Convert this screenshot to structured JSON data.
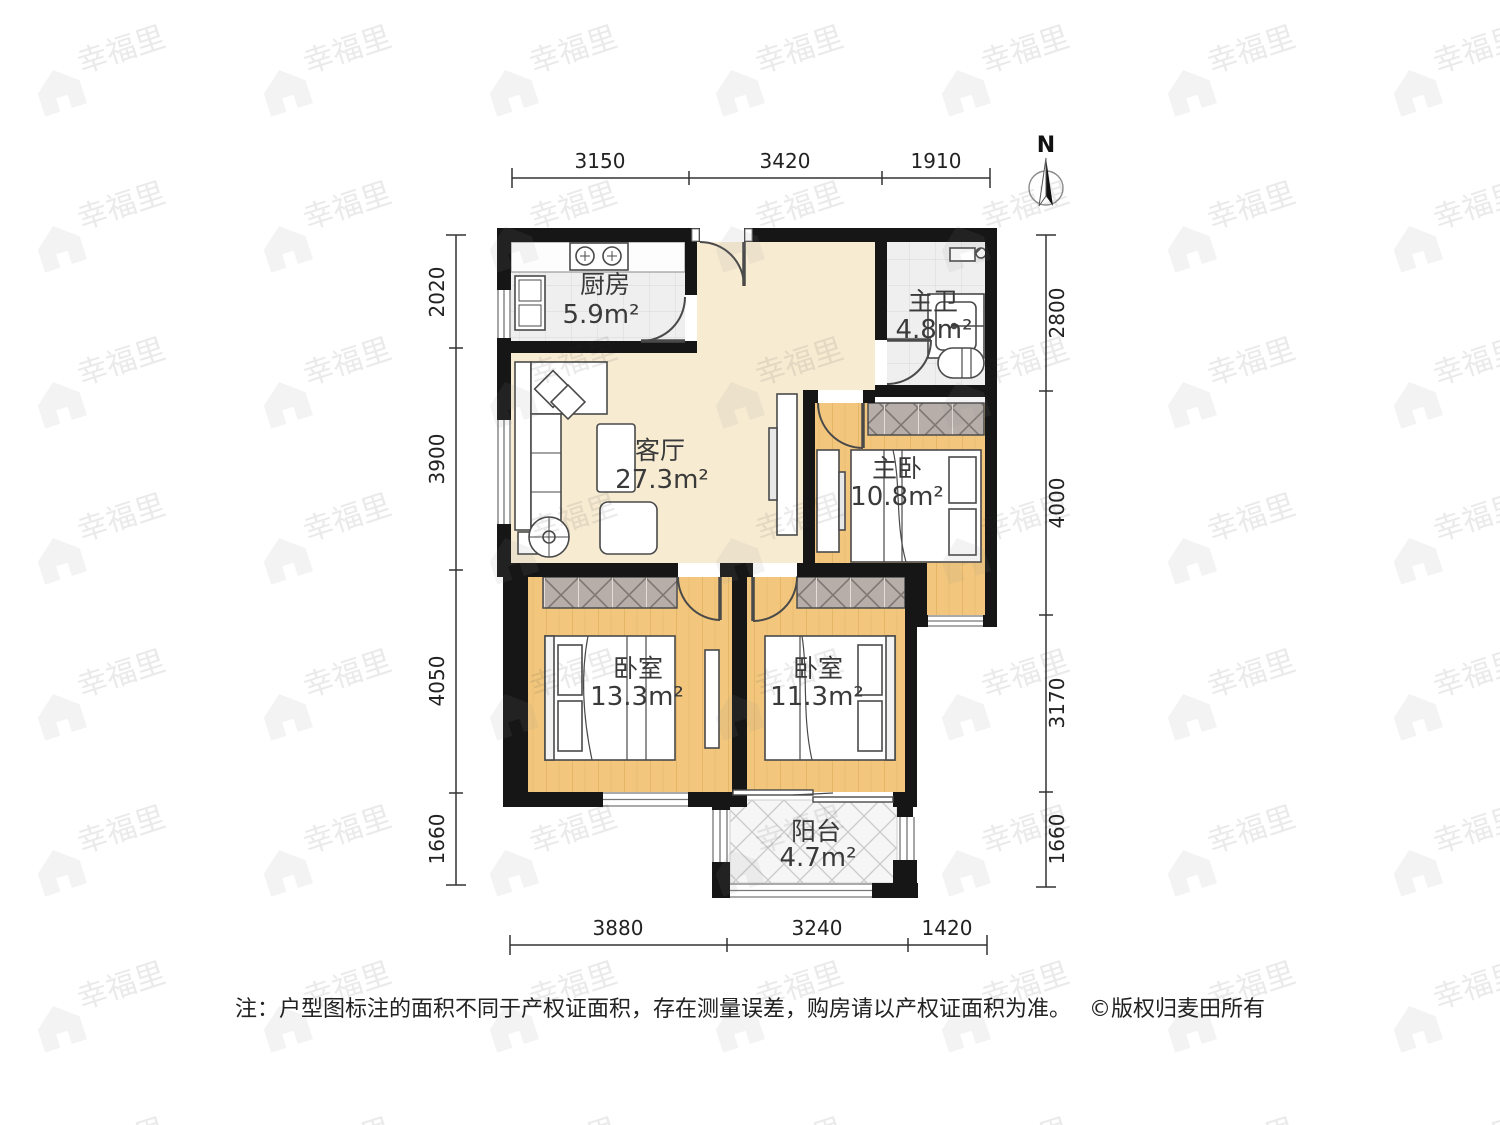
{
  "compass": {
    "label": "N"
  },
  "rooms": [
    {
      "id": "kitchen",
      "name": "厨房",
      "area": "5.9m²"
    },
    {
      "id": "master-bath",
      "name": "主卫",
      "area": "4.8m²"
    },
    {
      "id": "living-room",
      "name": "客厅",
      "area": "27.3m²"
    },
    {
      "id": "master-bedroom",
      "name": "主卧",
      "area": "10.8m²"
    },
    {
      "id": "bedroom-west",
      "name": "卧室",
      "area": "13.3m²"
    },
    {
      "id": "bedroom-east",
      "name": "卧室",
      "area": "11.3m²"
    },
    {
      "id": "balcony",
      "name": "阳台",
      "area": "4.7m²"
    }
  ],
  "dimensions": {
    "top": [
      "3150",
      "3420",
      "1910"
    ],
    "left": [
      "2020",
      "3900",
      "4050",
      "1660"
    ],
    "right": [
      "2800",
      "4000",
      "3170",
      "1660"
    ],
    "bottom": [
      "3880",
      "3240",
      "1420"
    ]
  },
  "footer": {
    "note": "注：户型图标注的面积不同于产权证面积，存在测量误差，购房请以产权证面积为准。",
    "copyright": "©版权归麦田所有"
  },
  "watermark": {
    "text": "幸福里"
  },
  "colors": {
    "wall": "#161616",
    "hall_floor": "#f7ebd2",
    "wood_floor": "#f2c77d",
    "tile_floor": "#efefef",
    "wardrobe": "#b7aeaa",
    "balcony_floor": "#f6f6f6"
  }
}
